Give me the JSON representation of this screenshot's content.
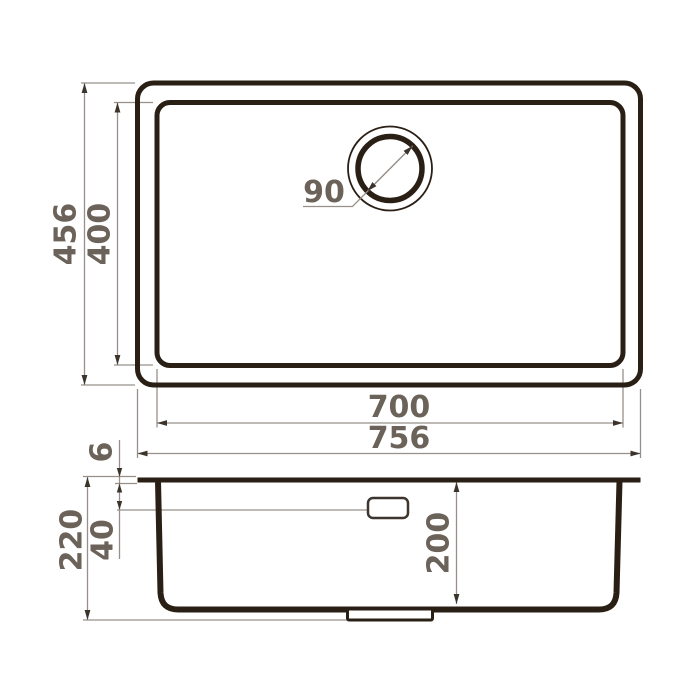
{
  "colors": {
    "background": "#ffffff",
    "outline": "#2a1f15",
    "dimension_line": "#97908a",
    "arrowhead": "#3c332b",
    "dimension_text": "#6b6259"
  },
  "top_view": {
    "overall_width": "756",
    "overall_depth": "456",
    "bowl_width": "700",
    "bowl_depth": "400",
    "drain_diameter": "90"
  },
  "side_view": {
    "rim_thickness": "6",
    "overall_height": "220",
    "ledge_offset": "40",
    "bowl_height": "200"
  }
}
